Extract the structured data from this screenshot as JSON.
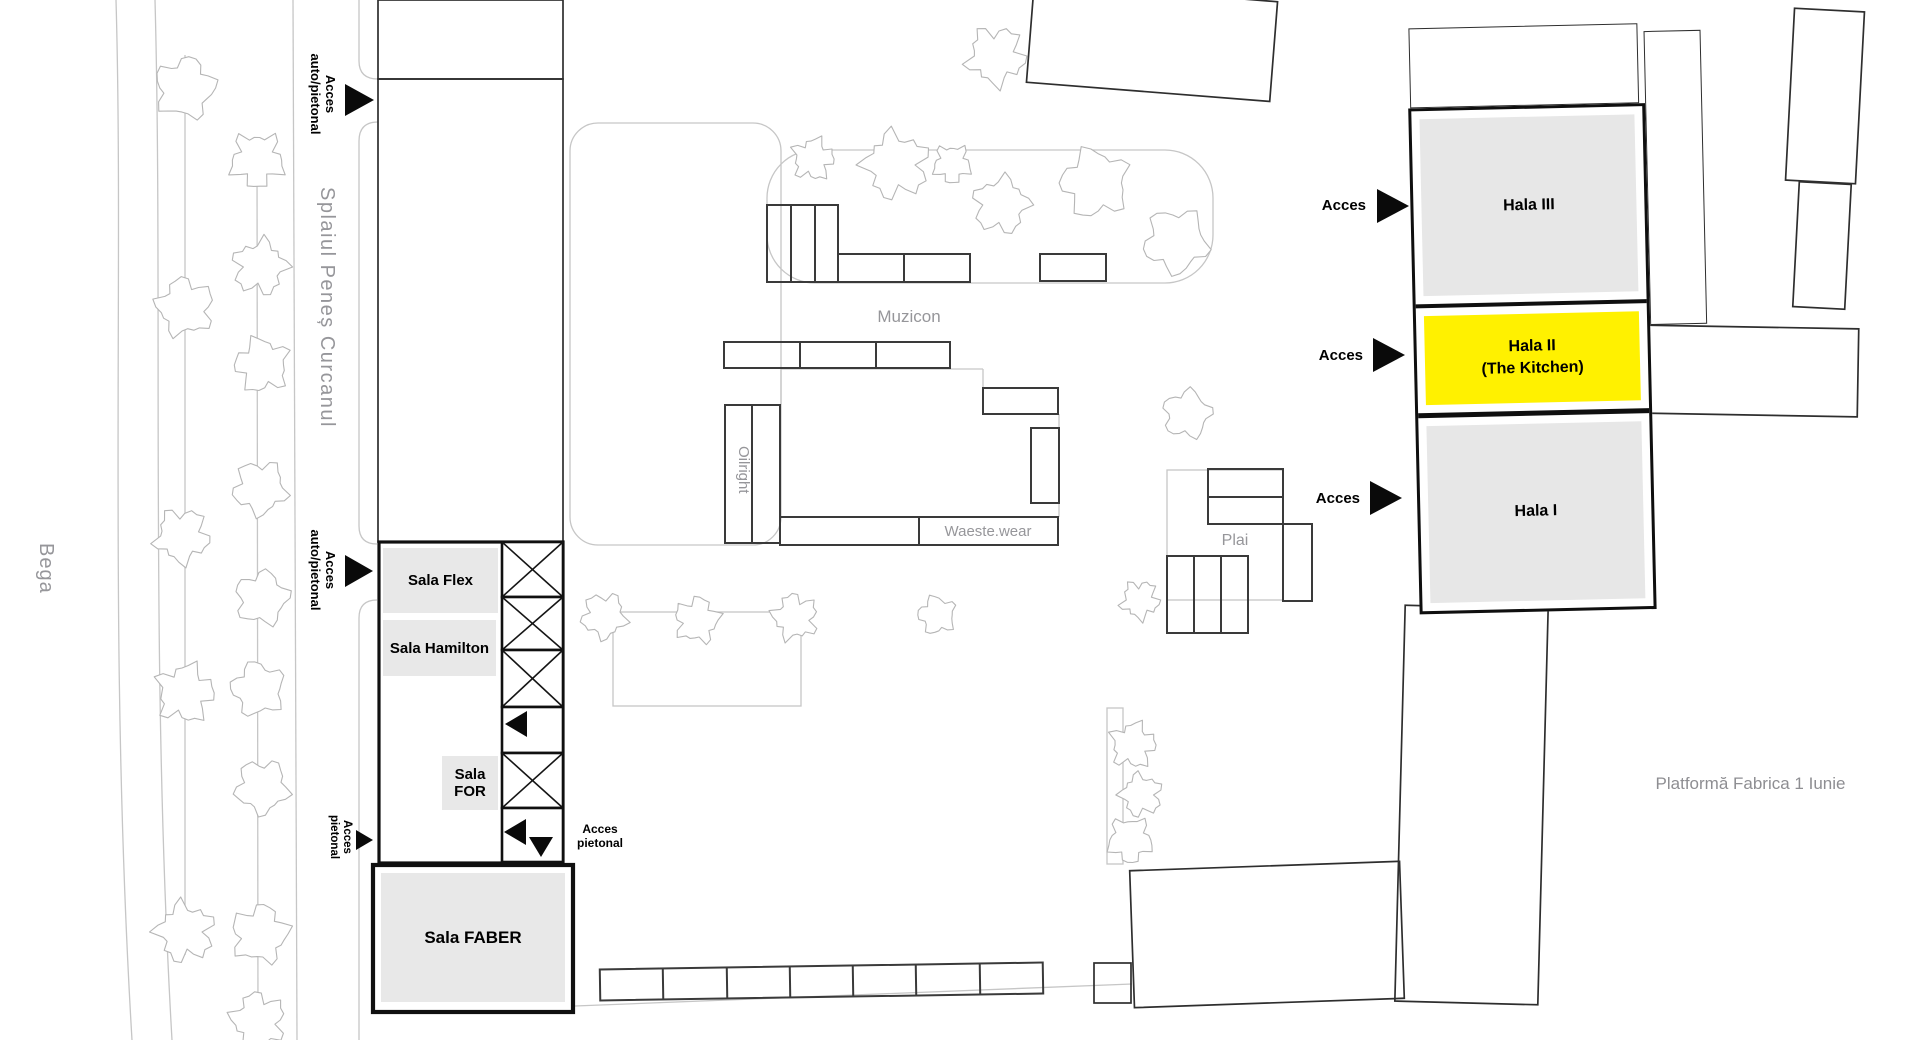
{
  "labels": {
    "street": "Splaiul Peneș Curcanul",
    "river": "Bega",
    "platform": "Platformă Fabrica 1 Iunie",
    "muzicon": "Muzicon",
    "oilright": "Oilright",
    "waeste_wear": "Waeste.wear",
    "plai": "Plai"
  },
  "access": {
    "auto_pedestrian": "Acces auto/pietonal",
    "pedestrian": "Acces pietonal",
    "short": "Acces"
  },
  "rooms": {
    "flex": "Sala Flex",
    "hamilton": "Sala Hamilton",
    "for": "Sala FOR",
    "faber": "Sala FABER"
  },
  "halls": {
    "hala3": "Hala III",
    "hala2_line1": "Hala II",
    "hala2_line2": "(The Kitchen)",
    "hala1": "Hala I"
  },
  "colors": {
    "highlight_yellow": "#FFF100",
    "building_fill_gray": "#e7e7e7",
    "arrow_black": "#0a0a0a",
    "map_line_gray": "#c6c6c6",
    "outline_dark": "#3a3a3a",
    "outline_medium": "#2e2e2e",
    "outline_thick": "#101010",
    "tree_gray": "#b5b5b5",
    "label_gray": "#96969a"
  },
  "geometry": {
    "paths": [
      {
        "d": "M116,0 C124,280 108,640 132,1040",
        "k": "g"
      },
      {
        "d": "M155,0 C163,300 150,660 172,1040",
        "k": "g"
      },
      {
        "d": "M293,0 L297,1040",
        "k": "g"
      },
      {
        "d": "M185,55 L185,955",
        "k": "g"
      },
      {
        "d": "M257,140 L258,1040",
        "k": "g"
      },
      {
        "d": "M359,0 L359,61 Q359,79 378,79",
        "k": "g"
      },
      {
        "d": "M378,122 Q359,122 359,141 L359,526 Q359,544 377,544",
        "k": "g"
      },
      {
        "d": "M377,600 Q359,600 359,618 L359,1040",
        "k": "g"
      },
      {
        "d": "M575,1006 L1132,984",
        "k": "g"
      },
      {
        "d": "M781,369 L983,369 M781,369 L781,405 M983,369 L983,388 M1059,414 L1059,428 M1059,503 L1059,517",
        "k": "g"
      }
    ],
    "rects": [
      {
        "x": 1030,
        "y": -8,
        "w": 244,
        "h": 100,
        "s": "m",
        "rot": 4.5
      },
      {
        "x": 378,
        "y": 0,
        "w": 185,
        "h": 79,
        "s": "m"
      },
      {
        "x": 378,
        "y": 79,
        "w": 185,
        "h": 463,
        "s": "m"
      },
      {
        "x": 570,
        "y": 123,
        "w": 211,
        "h": 422,
        "s": "g",
        "rx": 28
      },
      {
        "x": 379,
        "y": 542,
        "w": 184,
        "h": 321,
        "s": "t"
      },
      {
        "x": 383,
        "y": 548,
        "w": 115,
        "h": 65,
        "f": "#e8e8e8"
      },
      {
        "x": 383,
        "y": 620,
        "w": 113,
        "h": 56,
        "f": "#e8e8e8"
      },
      {
        "x": 442,
        "y": 756,
        "w": 56,
        "h": 54,
        "f": "#e8e8e8"
      },
      {
        "x": 373,
        "y": 865,
        "w": 200,
        "h": 147,
        "s": "T",
        "f": "#ffffff"
      },
      {
        "x": 381,
        "y": 873,
        "w": 184,
        "h": 129,
        "f": "#e8e8e8"
      },
      {
        "x": 767,
        "y": 150,
        "w": 446,
        "h": 133,
        "s": "g",
        "rx": 48
      },
      {
        "x": 767,
        "y": 205,
        "w": 71,
        "h": 77,
        "s": "d",
        "dv": [
          24,
          48
        ]
      },
      {
        "x": 838,
        "y": 254,
        "w": 66,
        "h": 28,
        "s": "d"
      },
      {
        "x": 904,
        "y": 254,
        "w": 66,
        "h": 28,
        "s": "d"
      },
      {
        "x": 1040,
        "y": 254,
        "w": 66,
        "h": 27,
        "s": "d"
      },
      {
        "x": 724,
        "y": 342,
        "w": 226,
        "h": 26,
        "s": "d",
        "dv": [
          76,
          152
        ]
      },
      {
        "x": 725,
        "y": 405,
        "w": 55,
        "h": 138,
        "s": "d",
        "dv": [
          27
        ]
      },
      {
        "x": 780,
        "y": 517,
        "w": 278,
        "h": 28,
        "s": "d",
        "dv": [
          139
        ]
      },
      {
        "x": 983,
        "y": 388,
        "w": 75,
        "h": 26,
        "s": "d"
      },
      {
        "x": 1031,
        "y": 428,
        "w": 28,
        "h": 75,
        "s": "d"
      },
      {
        "x": 613,
        "y": 612,
        "w": 188,
        "h": 94,
        "s": "g"
      },
      {
        "x": 1167,
        "y": 470,
        "w": 116,
        "h": 130,
        "s": "g"
      },
      {
        "x": 1208,
        "y": 469,
        "w": 75,
        "h": 55,
        "s": "d",
        "dh": [
          28
        ]
      },
      {
        "x": 1167,
        "y": 556,
        "w": 81,
        "h": 77,
        "s": "d",
        "dv": [
          27,
          54
        ]
      },
      {
        "x": 1283,
        "y": 524,
        "w": 29,
        "h": 77,
        "s": "d"
      },
      {
        "x": 1790,
        "y": 10,
        "w": 70,
        "h": 172,
        "s": "m",
        "rot": 3
      },
      {
        "x": 1796,
        "y": 183,
        "w": 52,
        "h": 125,
        "s": "m",
        "rot": 3
      },
      {
        "x": 1645,
        "y": 327,
        "w": 213,
        "h": 88,
        "s": "m",
        "rot": 1
      },
      {
        "x": 1400,
        "y": 607,
        "w": 143,
        "h": 396,
        "s": "m",
        "rot": 1.5
      },
      {
        "x": 1132,
        "y": 866,
        "w": 270,
        "h": 137,
        "s": "m",
        "rot": -2
      },
      {
        "x": 1094,
        "y": 963,
        "w": 37,
        "h": 40,
        "s": "m"
      },
      {
        "x": 600,
        "y": 966,
        "w": 443,
        "h": 31,
        "s": "d",
        "rot": -0.9,
        "dv": [
          63,
          127,
          190,
          253,
          316,
          380
        ]
      },
      {
        "x": 1107,
        "y": 708,
        "w": 16,
        "h": 156,
        "s": "g"
      }
    ],
    "corridor": {
      "x": 502,
      "w": 61,
      "cells": [
        {
          "y": 542,
          "h": 55,
          "x_mark": true
        },
        {
          "y": 597,
          "h": 53,
          "x_mark": true
        },
        {
          "y": 650,
          "h": 57,
          "x_mark": true
        },
        {
          "y": 707,
          "h": 46
        },
        {
          "y": 753,
          "h": 55,
          "x_mark": true
        },
        {
          "y": 808,
          "h": 54
        }
      ]
    },
    "arrows": [
      {
        "pts": "345,84 345,116 374,100",
        "name": "access-arrow-right"
      },
      {
        "pts": "345,555 345,587 373,571",
        "name": "access-arrow-right"
      },
      {
        "pts": "356,830 356,850 373,840",
        "name": "access-arrow-right-small"
      },
      {
        "pts": "1377,189 1377,223 1409,206",
        "name": "access-arrow-right"
      },
      {
        "pts": "1373,338 1373,372 1405,355",
        "name": "access-arrow-right"
      },
      {
        "pts": "1370,481 1370,515 1402,498",
        "name": "access-arrow-right"
      },
      {
        "pts": "527,711 527,737 505,724",
        "name": "access-arrow-left"
      },
      {
        "pts": "526,819 526,845 504,832",
        "name": "access-arrow-left"
      },
      {
        "pts": "529,837 553,837 541,857",
        "name": "access-arrow-down"
      }
    ],
    "trees": [
      [
        185,
        88,
        34
      ],
      [
        185,
        307,
        32
      ],
      [
        182,
        536,
        30
      ],
      [
        185,
        693,
        32
      ],
      [
        185,
        932,
        32
      ],
      [
        257,
        160,
        30
      ],
      [
        260,
        267,
        30
      ],
      [
        262,
        365,
        30
      ],
      [
        260,
        488,
        30
      ],
      [
        262,
        598,
        30
      ],
      [
        258,
        689,
        30
      ],
      [
        262,
        787,
        30
      ],
      [
        260,
        934,
        32
      ],
      [
        258,
        1020,
        30
      ],
      [
        996,
        56,
        32
      ],
      [
        813,
        159,
        23
      ],
      [
        896,
        165,
        36
      ],
      [
        952,
        164,
        21
      ],
      [
        1001,
        205,
        31
      ],
      [
        1095,
        183,
        38
      ],
      [
        1176,
        241,
        36
      ],
      [
        1187,
        414,
        27
      ],
      [
        937,
        615,
        21
      ],
      [
        604,
        616,
        25
      ],
      [
        697,
        620,
        25
      ],
      [
        795,
        617,
        25
      ],
      [
        1140,
        600,
        21
      ],
      [
        1133,
        745,
        25
      ],
      [
        1141,
        795,
        23
      ],
      [
        1130,
        840,
        25
      ]
    ]
  }
}
